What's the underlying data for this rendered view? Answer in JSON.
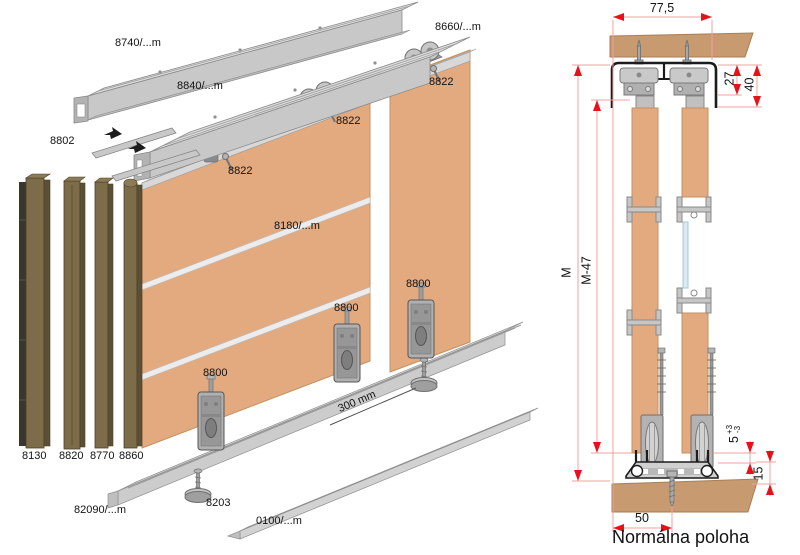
{
  "exploded": {
    "labels": {
      "top_rail": "8740/...m",
      "double_track": "8840/...m",
      "door_top_rail": "8660/...m",
      "insert": "8802",
      "roller_a": "8822",
      "roller_b": "8822",
      "roller_c": "8822",
      "divider_profile": "8180/...m",
      "bottom_bracket_a": "8800",
      "bottom_bracket_b": "8800",
      "bottom_bracket_c": "8800",
      "post_1": "8130",
      "post_2": "8820",
      "post_3": "8770",
      "post_4": "8860",
      "bottom_track": "82090/...m",
      "floor_glide": "8203",
      "bottom_guide": "0100/...m",
      "glide_spacing": "300 mm"
    }
  },
  "section": {
    "dims": {
      "width_total": "77,5",
      "track_inner_height": "27",
      "track_height": "40",
      "overall_height": "M",
      "door_height": "M-47",
      "bottom_gap": "5",
      "bottom_gap_tol_plus": "+3",
      "bottom_gap_tol_minus": "-3",
      "bottom_track_height": "15",
      "front_offset": "50"
    },
    "caption": "Normálna poloha"
  },
  "colors": {
    "wood_panel": "#e3aa7f",
    "wood_section": "#c79a70",
    "profile_gray": "#d8d8d8",
    "post_olive": "#7d6c49",
    "dimension_arrow_red": "#e8111a",
    "dimension_line_pink": "#f0a0a0",
    "glass_blue": "#d9eaf3",
    "track_outline_black": "#1c1c1c"
  }
}
